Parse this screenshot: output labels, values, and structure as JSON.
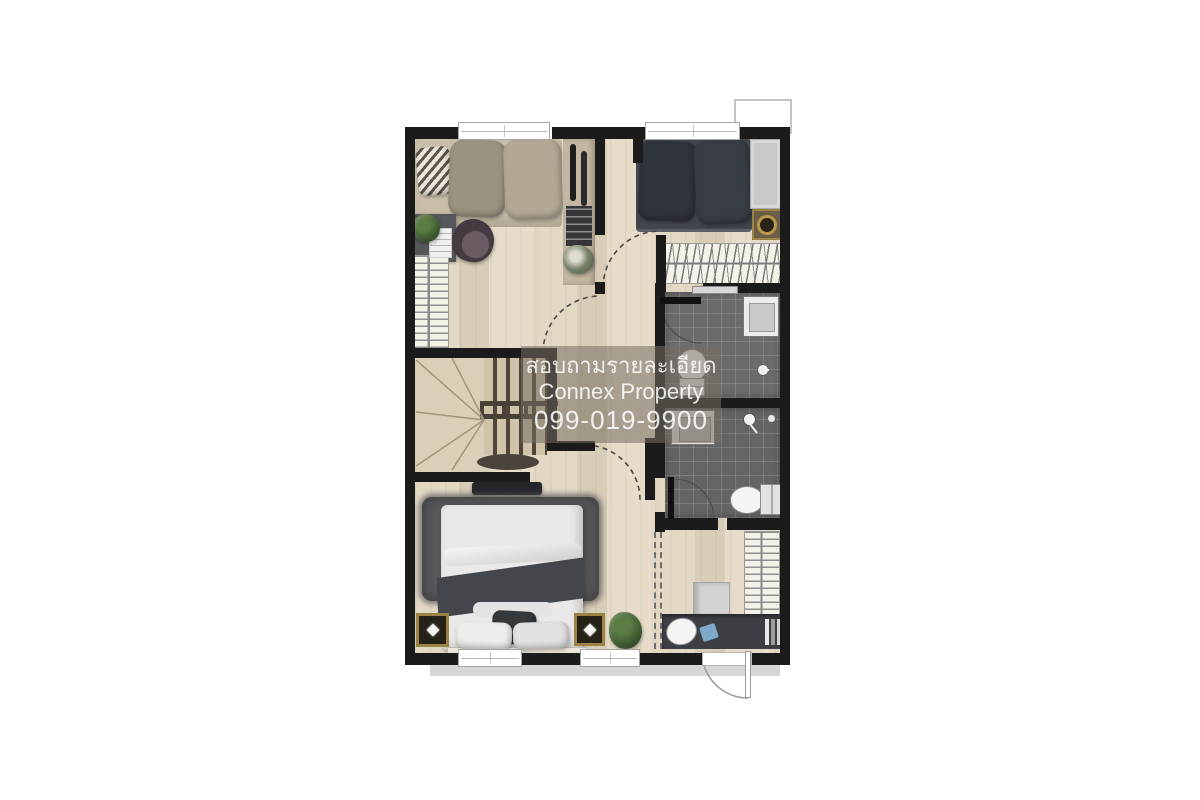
{
  "watermark": {
    "line1": "สอบถามรายละเอียด",
    "line2": "Connex Property",
    "line3": "099-019-9900"
  },
  "colors": {
    "wall": "#1b1b1b",
    "wood_floor": "#e2d8c4",
    "wood_plank": "#d8cdb7",
    "bath_floor": "#6b6b6b",
    "dark_furniture": "#3b3f43",
    "bed_dark": "#42474e",
    "bed_tan": "#c9bfa9",
    "rug": "#58585a",
    "gold": "#9a8344",
    "plant_green": "#3f5a31",
    "window_frame": "#a5a5a5",
    "watermark_bg": "rgba(118,110,98,0.55)",
    "watermark_text": "rgba(255,255,255,0.85)"
  },
  "elements": [
    "bed",
    "pillow",
    "wardrobe",
    "closet-hangers",
    "desk",
    "chair",
    "console-shelf",
    "staircase",
    "stair-railing",
    "toilet",
    "sink",
    "shower-head",
    "towel-rail",
    "washing-machine",
    "vanity-counter",
    "rug",
    "nightstand",
    "tv-console",
    "potted-plant",
    "door-swing-arc",
    "window",
    "balcony-door",
    "ac-ledge"
  ]
}
